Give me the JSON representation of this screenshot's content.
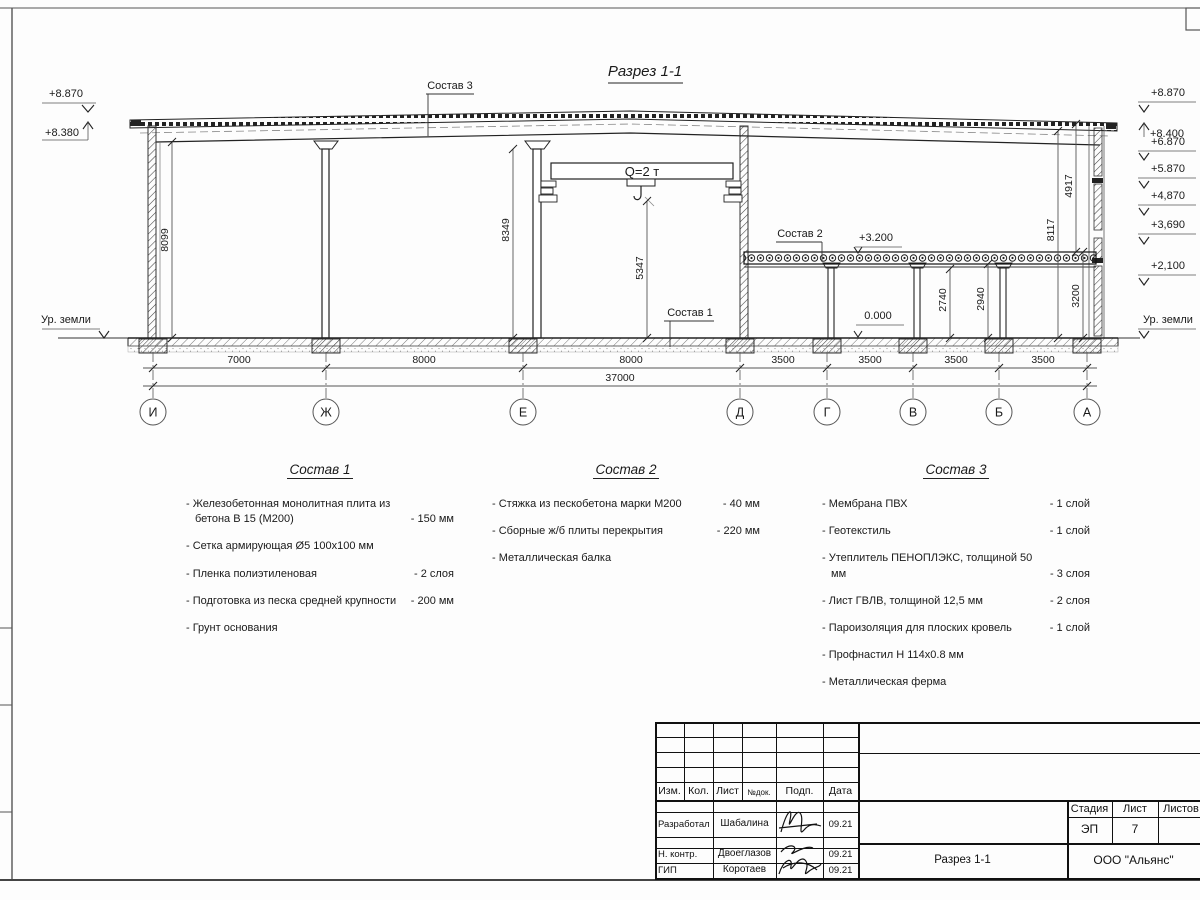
{
  "drawing": {
    "title": "Разрез 1-1",
    "crane": "Q=2 т",
    "ground": "Ур. земли",
    "callout1": "Состав 1",
    "callout2": "Состав 2",
    "callout3": "Состав 3",
    "level_mezz": "+3.200",
    "level_zero": "0.000",
    "elev_left": [
      "+8.870",
      "+8.380"
    ],
    "elev_right": [
      "+8.870",
      "+8.400",
      "+6.870",
      "+5.870",
      "+4,870",
      "+3,690",
      "+2,100"
    ],
    "vdim": {
      "bay_left": "8099",
      "bay_mid": "8349",
      "hook": "5347",
      "mezz_beam": "2740",
      "mezz_slab": "2940",
      "mezz_floor": "3200",
      "right_full": "8117",
      "right_upper": "4917"
    },
    "hdim": [
      "7000",
      "8000",
      "8000",
      "3500",
      "3500",
      "3500",
      "3500"
    ],
    "hdim_total": "37000",
    "axes": [
      "И",
      "Ж",
      "Е",
      "Д",
      "Г",
      "В",
      "Б",
      "А"
    ]
  },
  "specs": [
    {
      "title": "Состав 1",
      "items": [
        {
          "text": "- Железобетонная  монолитная плита из бетона В 15 (М200)",
          "value": "- 150 мм"
        },
        {
          "text": "- Сетка армирующая Ø5 100х100 мм",
          "value": ""
        },
        {
          "text": "- Пленка полиэтиленовая",
          "value": "-  2 слоя"
        },
        {
          "text": "- Подготовка из песка средней крупности",
          "value": "- 200 мм"
        },
        {
          "text": "- Грунт основания",
          "value": ""
        }
      ]
    },
    {
      "title": "Состав 2",
      "items": [
        {
          "text": "- Стяжка из пескобетона марки М200",
          "value": "- 40 мм"
        },
        {
          "text": "- Сборные ж/б плиты перекрытия",
          "value": "- 220 мм"
        },
        {
          "text": "- Металлическая балка",
          "value": ""
        }
      ]
    },
    {
      "title": "Состав 3",
      "items": [
        {
          "text": "- Мембрана ПВХ",
          "value": "- 1 слой"
        },
        {
          "text": "- Геотекстиль",
          "value": "- 1 слой"
        },
        {
          "text": "- Утеплитель ПЕНОПЛЭКС, толщиной 50 мм",
          "value": "- 3 слоя"
        },
        {
          "text": "- Лист ГВЛВ, толщиной 12,5 мм",
          "value": "- 2 слоя"
        },
        {
          "text": "- Пароизоляция для плоских кровель",
          "value": "- 1 слой"
        },
        {
          "text": "- Профнастил Н 114х0.8 мм",
          "value": ""
        },
        {
          "text": "- Металлическая ферма",
          "value": ""
        }
      ]
    }
  ],
  "titleblock": {
    "cols": [
      "Изм.",
      "Кол.",
      "Лист",
      "№док.",
      "Подп.",
      "Дата"
    ],
    "rows": [
      {
        "role": "Разработал",
        "name": "Шабалина",
        "date": "09.21"
      },
      {
        "role": "Н. контр.",
        "name": "Двоеглазов",
        "date": "09.21"
      },
      {
        "role": "ГИП",
        "name": "Коротаев",
        "date": "09.21"
      }
    ],
    "stage_label": "Стадия",
    "sheet_label": "Лист",
    "sheets_label": "Листов",
    "stage": "ЭП",
    "sheet": "7",
    "doc_title": "Разрез 1-1",
    "company": "ООО \"Альянс\""
  }
}
